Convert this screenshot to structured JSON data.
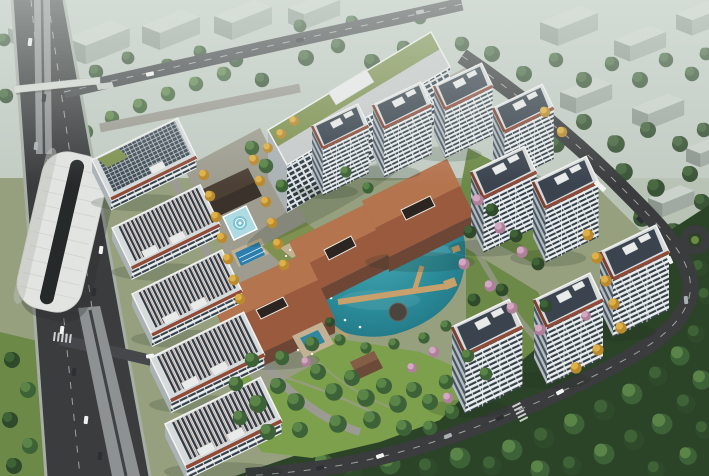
{
  "scene": {
    "type": "architectural-aerial-rendering",
    "description": "Aerial daytime rendering of a residential development: white apartment towers with red-brown roof trim arranged around a turquoise central lake, terracotta-roofed clubhouse pavilions, landscaped gardens with autumn and cherry-blossom trees, an elevated metro station and highway on the left, a long office slab with green roof at the top, a central park lawn, and dense forest with a curving road at the lower right. Hazy city blocks fill the background.",
    "width": 709,
    "height": 476,
    "inventory": {
      "residential_towers": 9,
      "garden_slab_buildings": 5,
      "office_buildings": 2,
      "clubhouse_roofs": 3,
      "pavilions": 2,
      "lakes": 1,
      "pools": 3,
      "fountains": 2,
      "metro_stations": 1,
      "roundabouts": 1
    },
    "features": [
      "elevated-metro-station",
      "left-highway",
      "pedestrian-overpass",
      "top-road",
      "office-building-green-roof",
      "residential-towers",
      "garden-slab-buildings",
      "clubhouse-main-roof",
      "clubhouse-west-roof",
      "clubhouse-south-roof",
      "central-lake",
      "boardwalk-piers",
      "lake-fountain",
      "fountain-plaza-pool",
      "lap-pool",
      "rooftop-terrace",
      "autumn-tree-rows",
      "blossom-trees",
      "central-park-lawn",
      "forest",
      "east-ring-road",
      "roundabout",
      "traffic"
    ]
  },
  "palette": {
    "ground": "#96a07f",
    "hazeTop": "#c2ccc3",
    "bgRoof": "#cbd2cb",
    "bgFace": "#a0aaa2",
    "bgSide": "#8c968e",
    "treeDark": "#2e4a2b",
    "treeDark2": "#3f6236",
    "treeGreen": "#3e6238",
    "treeGreen2": "#5b8448",
    "treeYellow": "#b98a2e",
    "treeYellow2": "#ddb04a",
    "treePink": "#b07f9b",
    "treePink2": "#d3a8c2",
    "forest": "#2b4428",
    "parkLawn": "#7da04c",
    "lawn2": "#6d8948",
    "roadDark": "#3a3c3d",
    "roadMid": "#45474a",
    "roadLight": "#9c9b93",
    "sidewalk": "#a7aea6",
    "viaduct": "#8e9192",
    "stationRoof": "#e2e4e1",
    "stationGap": "#26292a",
    "lake": "#2a8a98",
    "pier": "#c8a06b",
    "deckTan": "#c2b193",
    "roofTerra": "#9a5a3e",
    "roofTerraLight": "#b4744e",
    "clubWall": "#6e4636",
    "trimRed": "#8f4b38",
    "trimRedDark": "#7c4030",
    "facade": "#eceeee",
    "winDark": "#33404b",
    "sideFacade": "#b4bcc3",
    "sideWin": "#46525c",
    "roofDeck": "#d7dada",
    "roofInner": "#3a434e",
    "parapet": "#f1f2f1",
    "roofBox": "#e9ebea",
    "greenRoof": "#7f9150",
    "officeBg": "#dfe3e4",
    "officeWin": "#2f3a45",
    "officeSide": "#aab2b6",
    "glassDark": "#3f4b55",
    "glassLine": "#c2c9cd",
    "poolBlue": "#2b7fae",
    "poolAqua": "#7fc4d2",
    "poolPale": "#aedae2",
    "pavingWarm": "#9d9c8f",
    "plazaGray": "#a3a399",
    "shadowC": "#1e2a1e"
  }
}
